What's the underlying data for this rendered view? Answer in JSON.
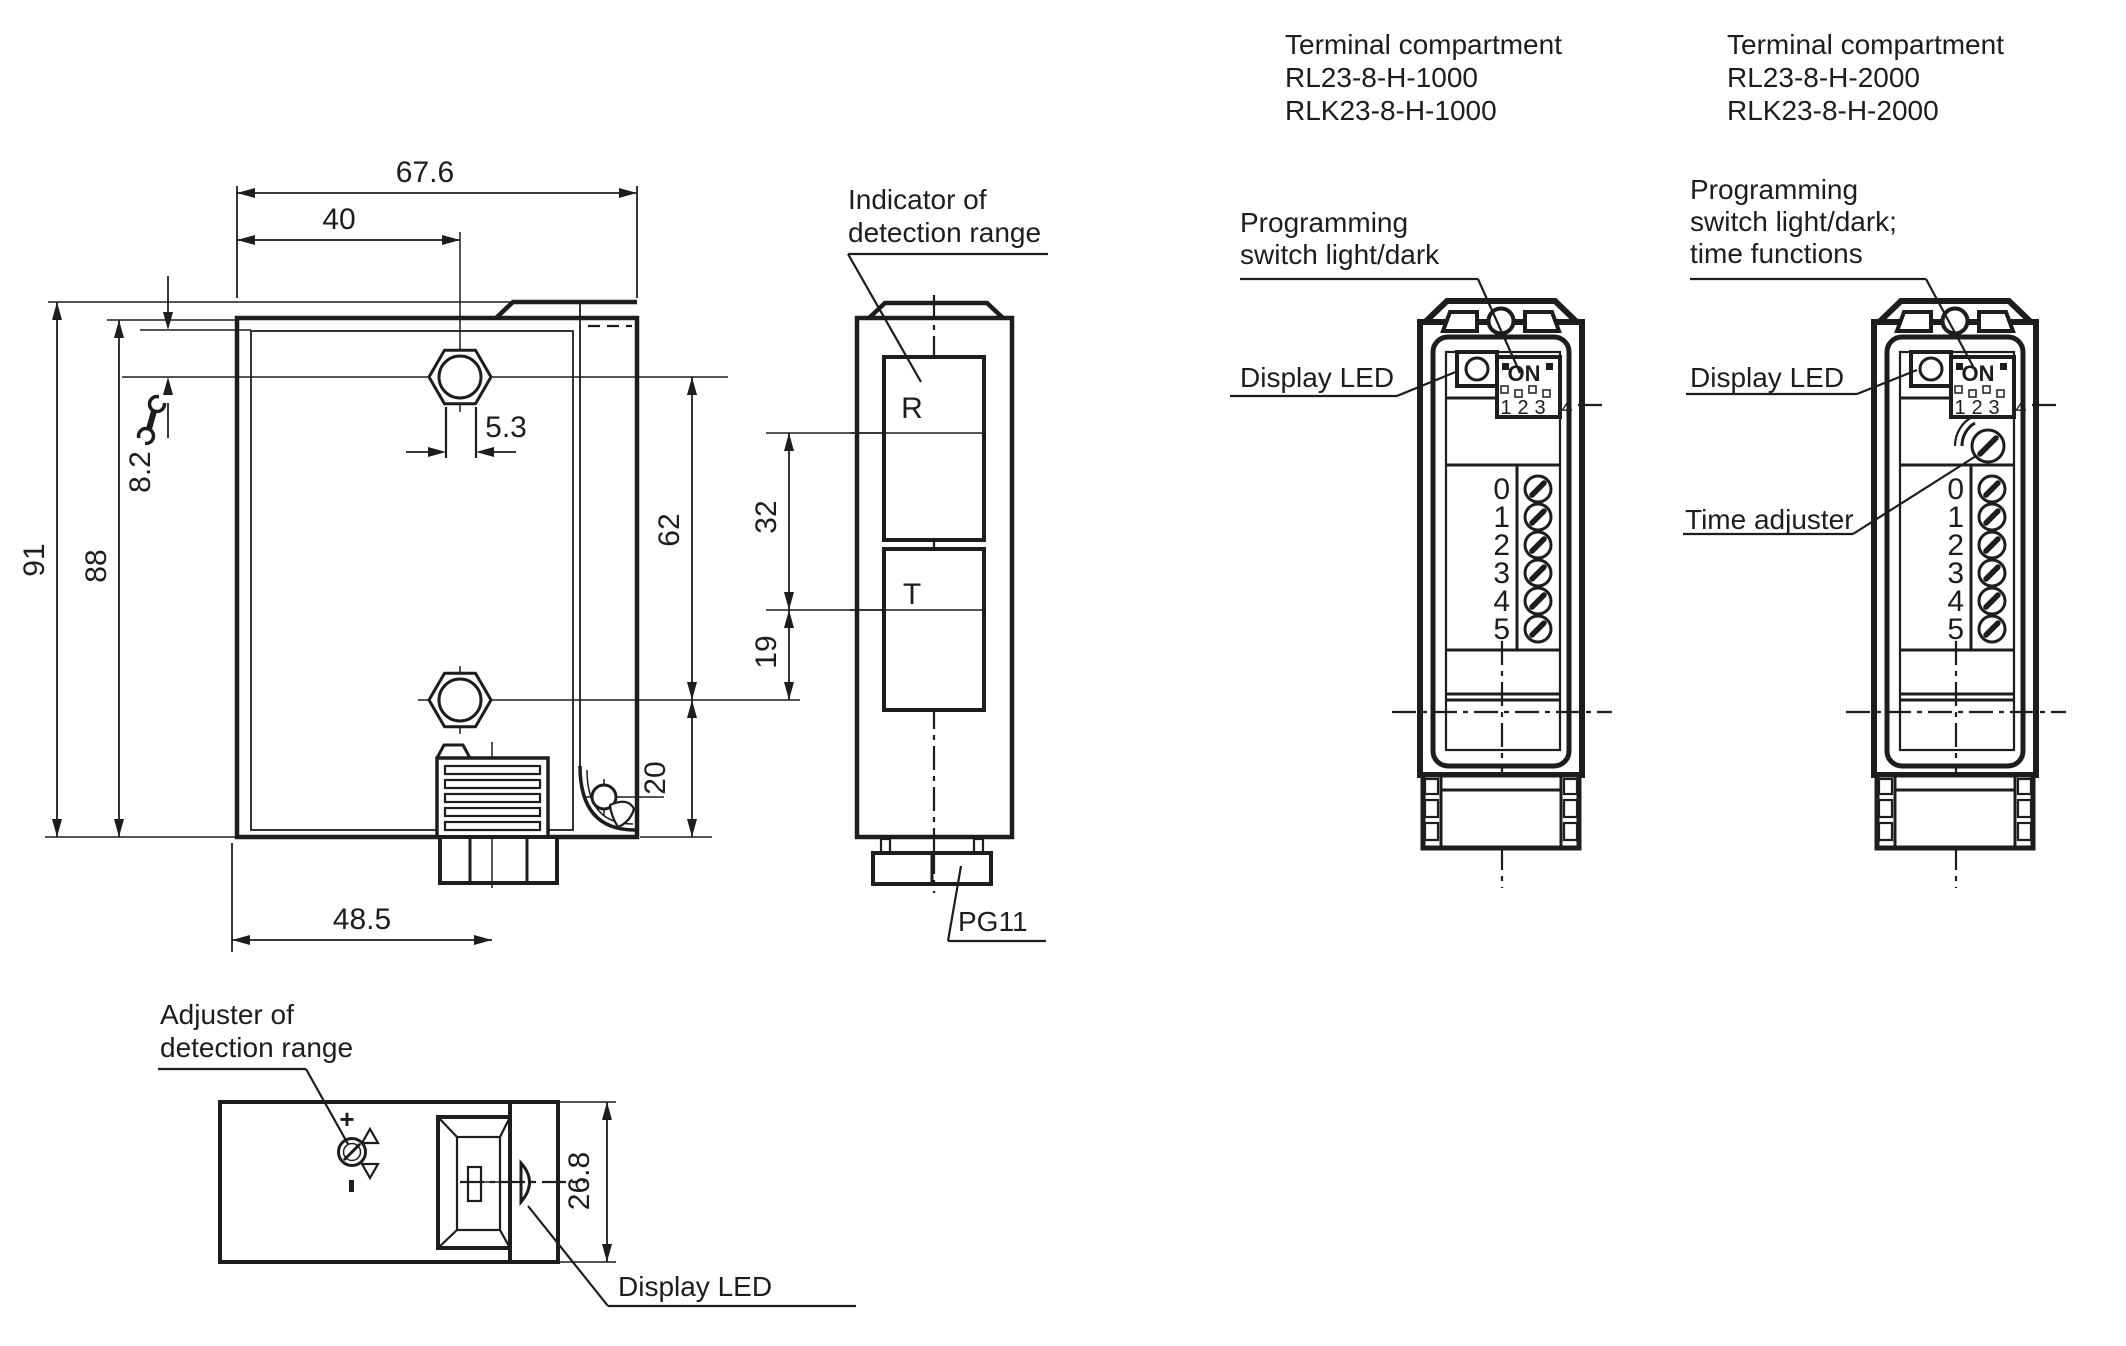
{
  "front_view": {
    "dim_width": "67.6",
    "dim_hole_x": "40",
    "dim_slot": "5.3",
    "dim_top_offset": "8.2",
    "dim_height_total": "91",
    "dim_height_face": "88",
    "dim_gland_x": "48.5"
  },
  "side_view": {
    "indicator_label_1": "Indicator of",
    "indicator_label_2": "detection range",
    "receiver": "R",
    "transmitter": "T",
    "cable_gland": "PG11",
    "dim_hole_span": "62",
    "dim_axis_span": "32",
    "dim_t_axis": "19",
    "dim_bottom": "20"
  },
  "bottom_view": {
    "adjuster_label_1": "Adjuster of",
    "adjuster_label_2": "detection range",
    "display_led_label": "Display LED",
    "plus_mark": "+",
    "dim_depth": "26.8"
  },
  "device1": {
    "title_1": "Terminal compartment",
    "title_2": "RL23-8-H-1000",
    "title_3": "RLK23-8-H-1000",
    "programming_label_1": "Programming",
    "programming_label_2": "switch light/dark",
    "display_led_label": "Display LED",
    "dip_on": "ON",
    "dip_positions": [
      "1",
      "2",
      "3",
      "4"
    ],
    "terminals": [
      "0",
      "1",
      "2",
      "3",
      "4",
      "5"
    ]
  },
  "device2": {
    "title_1": "Terminal compartment",
    "title_2": "RL23-8-H-2000",
    "title_3": "RLK23-8-H-2000",
    "programming_label_1": "Programming",
    "programming_label_2": "switch light/dark;",
    "programming_label_3": "time functions",
    "display_led_label": "Display LED",
    "time_adjuster_label": "Time adjuster",
    "dip_on": "ON",
    "dip_positions": [
      "1",
      "2",
      "3",
      "4"
    ],
    "terminals": [
      "0",
      "1",
      "2",
      "3",
      "4",
      "5"
    ]
  },
  "colors": {
    "ink": "#1d1d1b",
    "background": "#ffffff"
  }
}
